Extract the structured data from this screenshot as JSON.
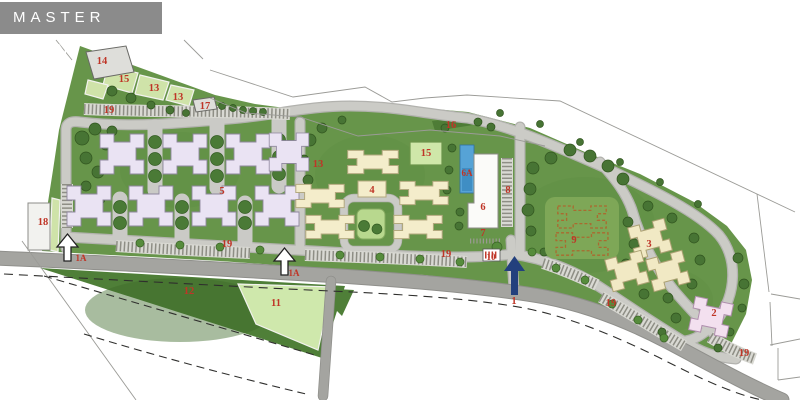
{
  "title": {
    "text": "MASTER PLAN"
  },
  "colors": {
    "title_bg": "#8b8b8b",
    "title_text": "#ffffff",
    "label_red": "#bf3527",
    "site_green": "#67954a",
    "site_green_dark": "#4c7b36",
    "plot_green_light": "#cfe3a9",
    "road_internal": "#cbcbc6",
    "road_main": "#a4a4a0",
    "building_lavender": "#eae3f3",
    "building_cream": "#f4edcb",
    "building_pink": "#f3e0ef",
    "building_white": "#fbfbf9",
    "building_gray": "#dededa",
    "pool_blue": "#56a3d6",
    "arrow_navy": "#23407d",
    "future_outline_orange": "#aa6a2f"
  },
  "plan": {
    "labels": [
      {
        "text": "14"
      },
      {
        "text": "15"
      },
      {
        "text": "13"
      },
      {
        "text": "13"
      },
      {
        "text": "17"
      },
      {
        "text": "19"
      },
      {
        "text": "5"
      },
      {
        "text": "18"
      },
      {
        "text": "1A"
      },
      {
        "text": "12"
      },
      {
        "text": "19"
      },
      {
        "text": "1A"
      },
      {
        "text": "11"
      },
      {
        "text": "13"
      },
      {
        "text": "4"
      },
      {
        "text": "15"
      },
      {
        "text": "16"
      },
      {
        "text": "6A"
      },
      {
        "text": "6"
      },
      {
        "text": "8"
      },
      {
        "text": "7"
      },
      {
        "text": "10"
      },
      {
        "text": "19"
      },
      {
        "text": "1"
      },
      {
        "text": "9"
      },
      {
        "text": "3"
      },
      {
        "text": "19"
      },
      {
        "text": "2"
      },
      {
        "text": "19"
      }
    ]
  }
}
